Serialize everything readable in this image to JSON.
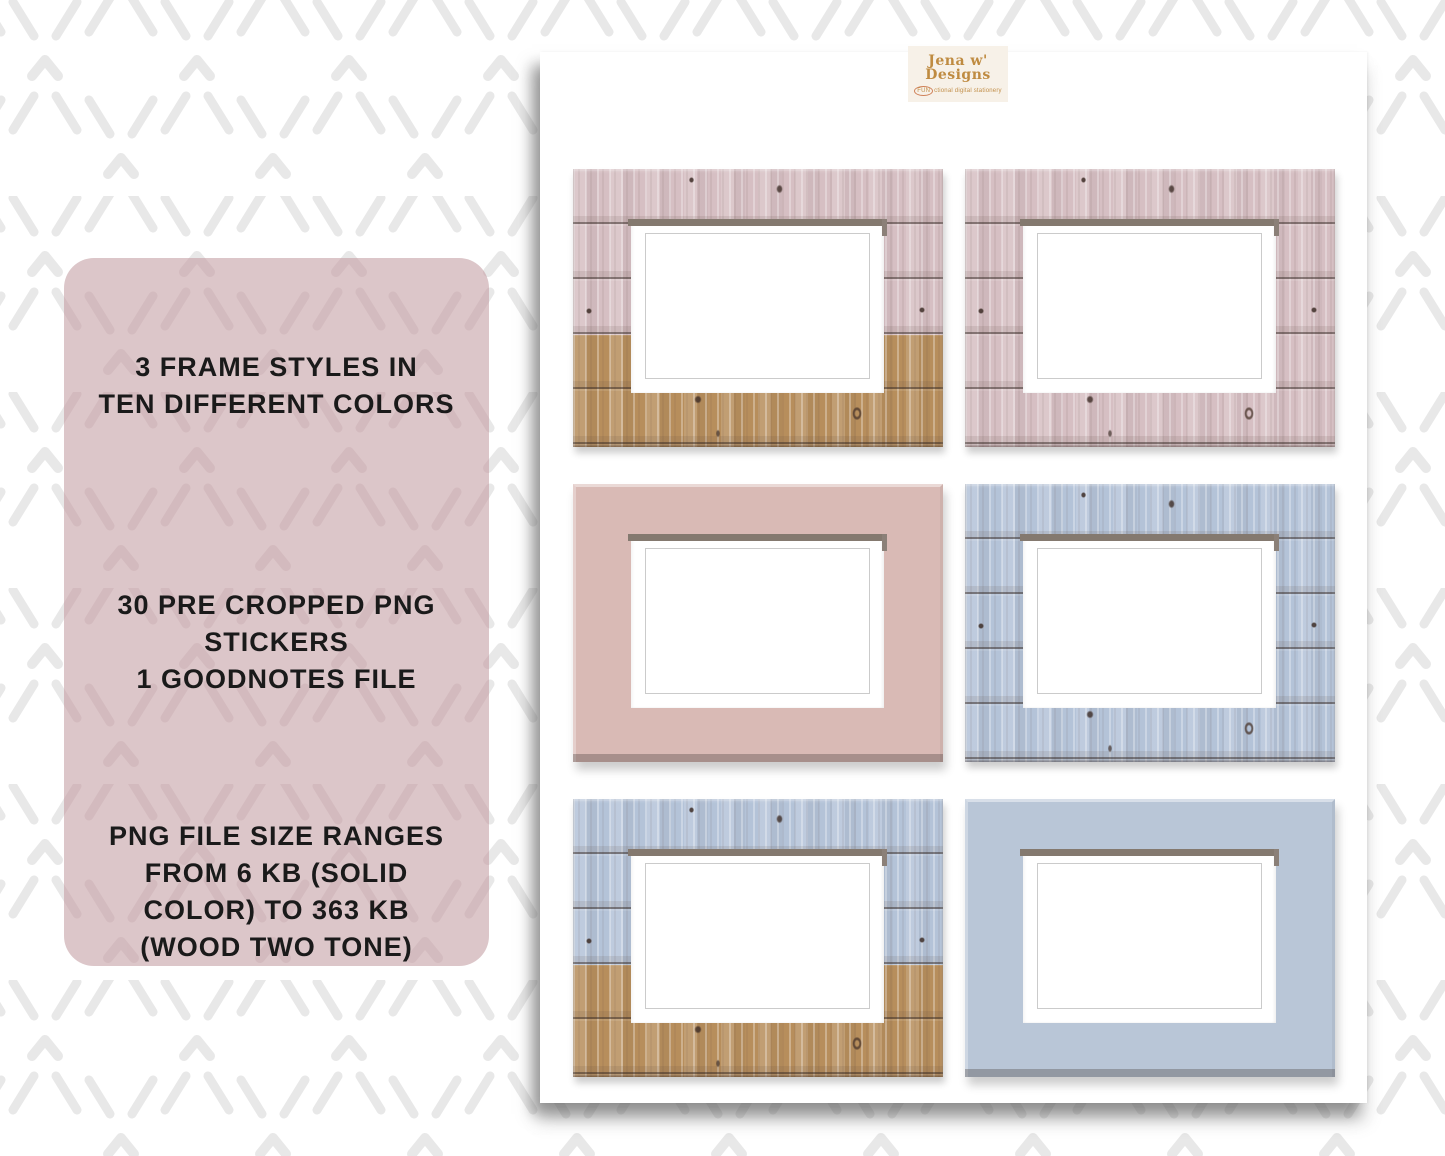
{
  "info_panel": {
    "bg_color": "#dcc6c9",
    "text_color": "#1a1a1a",
    "sections": [
      {
        "text": "3 FRAME STYLES IN\nTEN DIFFERENT COLORS"
      },
      {
        "text": "30 PRE CROPPED PNG\nSTICKERS\n1 GOODNOTES FILE"
      },
      {
        "text": "PNG FILE SIZE RANGES\nFROM 6 KB (SOLID\nCOLOR) TO 363 KB\n(WOOD TWO TONE)"
      }
    ]
  },
  "page": {
    "logo": {
      "brand_top": "Jena w'",
      "brand_bottom": "Designs",
      "tagline_highlight": "fun",
      "tagline_rest": "ctional digital stationery",
      "gold": "#bf8b41",
      "card_bg": "#f7f1e8"
    },
    "frames": [
      {
        "name": "frame-wood-two-tone-pink-tan",
        "style": "wood",
        "two_tone": true,
        "top_color": "#d6bfc3",
        "bottom_color": "#b78e5c"
      },
      {
        "name": "frame-wood-pink",
        "style": "wood",
        "two_tone": false,
        "top_color": "#d6bfc3",
        "bottom_color": "#d6bfc3"
      },
      {
        "name": "frame-solid-pink",
        "style": "solid",
        "two_tone": false,
        "top_color": "#d9bab5",
        "bottom_color": "#d9bab5"
      },
      {
        "name": "frame-wood-blue",
        "style": "wood",
        "two_tone": false,
        "top_color": "#b4c3d8",
        "bottom_color": "#b4c3d8"
      },
      {
        "name": "frame-wood-two-tone-blue-tan",
        "style": "wood",
        "two_tone": true,
        "top_color": "#b4c3d8",
        "bottom_color": "#b78e5c"
      },
      {
        "name": "frame-solid-blue",
        "style": "solid",
        "two_tone": false,
        "top_color": "#b9c6d7",
        "bottom_color": "#b9c6d7"
      }
    ]
  },
  "pattern": {
    "mark_color_page": "#e8e8e8",
    "mark_color_panel": "#cdb2b6"
  }
}
